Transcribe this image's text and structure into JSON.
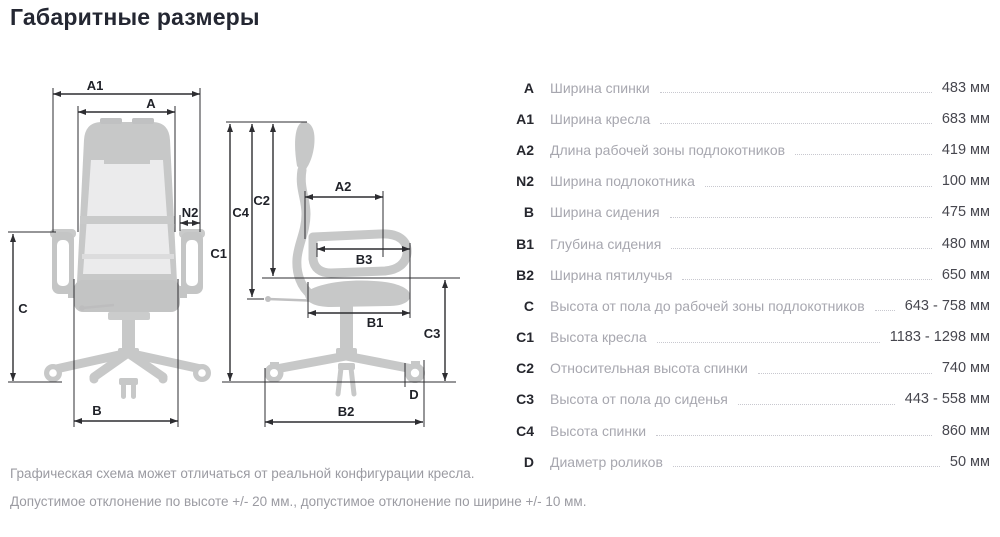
{
  "title": "Габаритные размеры",
  "diagram": {
    "front": {
      "a1": "A1",
      "a": "A",
      "n2": "N2",
      "c": "C",
      "b": "B"
    },
    "side": {
      "c1": "C1",
      "c2": "C2",
      "c4": "C4",
      "a2": "A2",
      "b3": "B3",
      "b1": "B1",
      "c3": "C3",
      "d": "D",
      "b2": "B2"
    }
  },
  "table": {
    "rows": [
      {
        "code": "A",
        "label": "Ширина спинки",
        "value": "483 мм"
      },
      {
        "code": "A1",
        "label": "Ширина кресла",
        "value": "683 мм"
      },
      {
        "code": "A2",
        "label": "Длина рабочей зоны подлокотников",
        "value": "419 мм"
      },
      {
        "code": "N2",
        "label": "Ширина подлокотника",
        "value": "100 мм"
      },
      {
        "code": "B",
        "label": "Ширина сидения",
        "value": "475 мм"
      },
      {
        "code": "B1",
        "label": "Глубина сидения",
        "value": "480 мм"
      },
      {
        "code": "B2",
        "label": "Ширина пятилучья",
        "value": "650 мм"
      },
      {
        "code": "C",
        "label": "Высота от пола до рабочей зоны подлокотников",
        "value": "643 - 758 мм"
      },
      {
        "code": "C1",
        "label": "Высота кресла",
        "value": "1183 - 1298 мм"
      },
      {
        "code": "C2",
        "label": "Относительная высота спинки",
        "value": "740 мм"
      },
      {
        "code": "C3",
        "label": "Высота от пола до сиденья",
        "value": "443 - 558 мм"
      },
      {
        "code": "C4",
        "label": "Высота спинки",
        "value": "860 мм"
      },
      {
        "code": "D",
        "label": "Диаметр роликов",
        "value": "50 мм"
      }
    ]
  },
  "footnotes": {
    "line1": "Графическая схема может отличаться от реальной конфигурации кресла.",
    "line2": "Допустимое отклонение по высоте +/- 20 мм., допустимое отклонение по ширине +/- 10 мм."
  },
  "colors": {
    "chair_body": "#c7c8c8",
    "chair_mesh": "#ebebec",
    "dimension_line": "#2d2d31",
    "code_text": "#26272e",
    "label_text": "#a7a7af",
    "value_text": "#47474f",
    "leader_dots": "#c8c8cf",
    "footnote_text": "#9b9ba2"
  }
}
